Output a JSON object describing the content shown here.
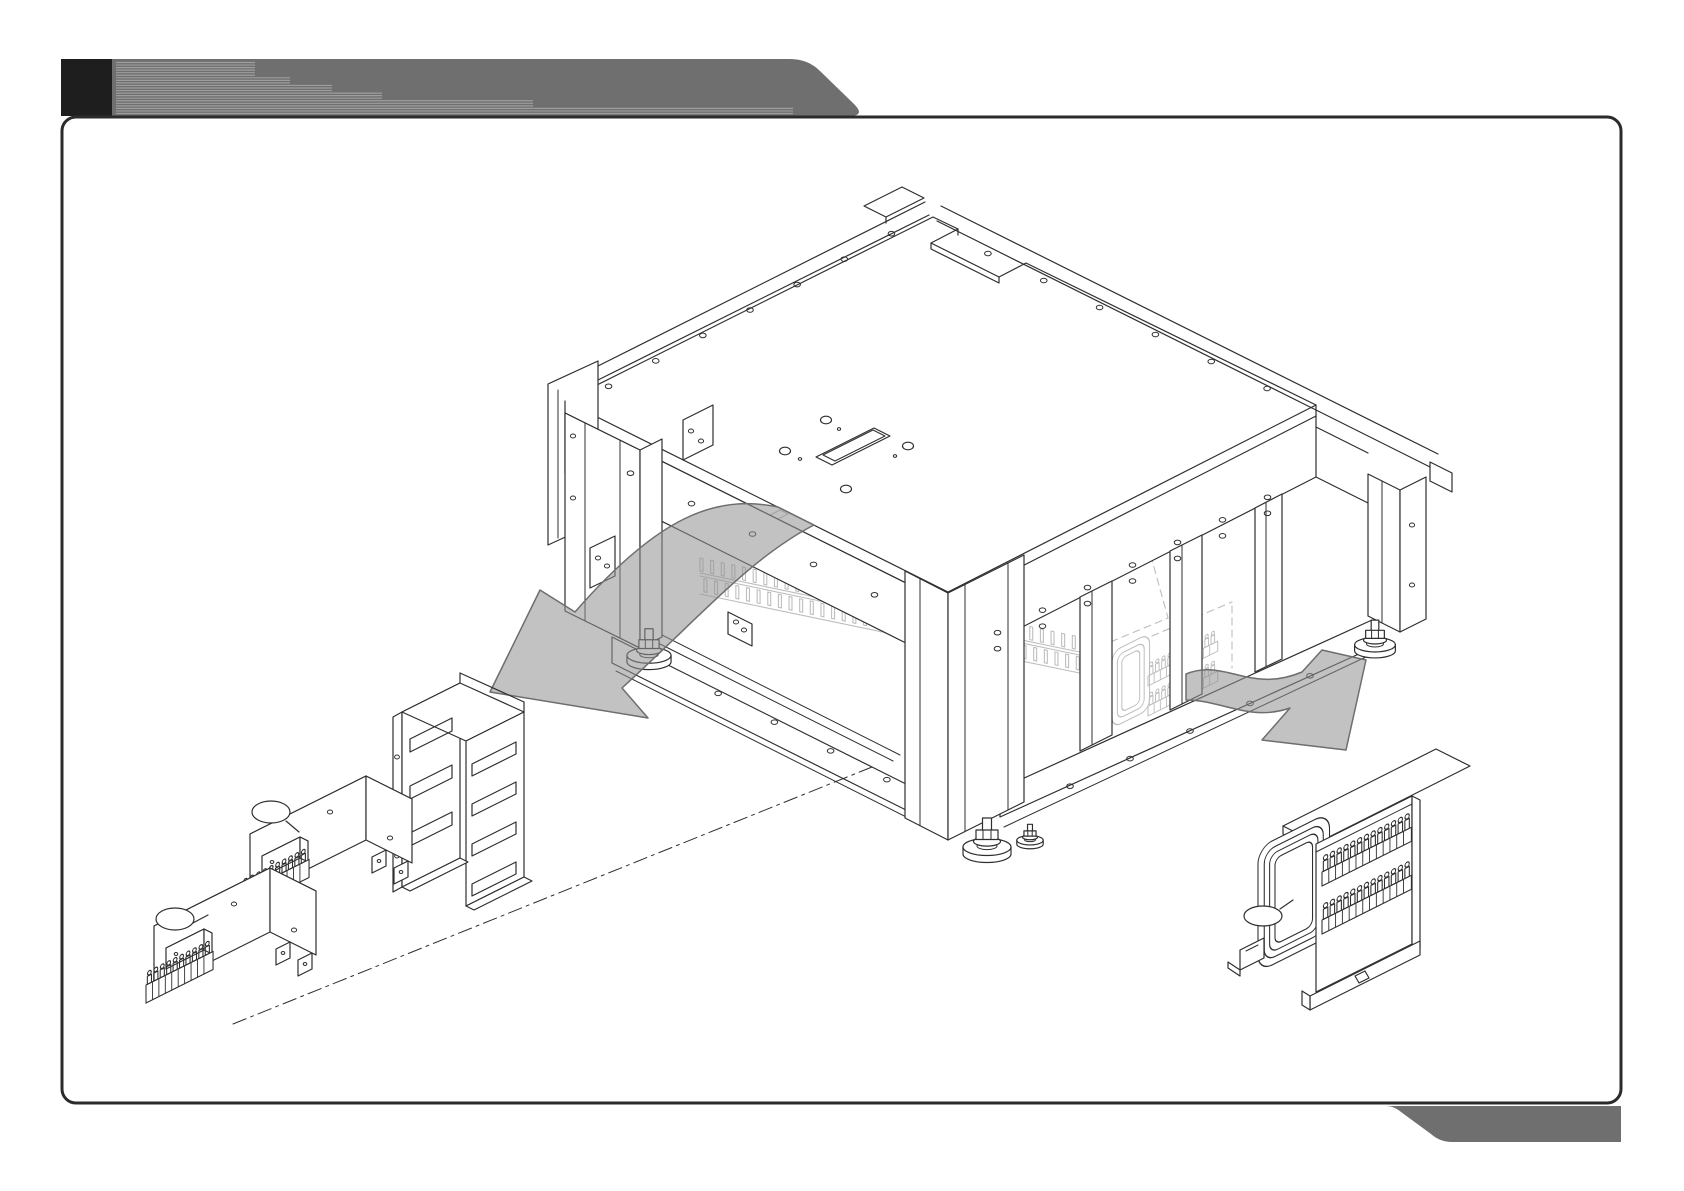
{
  "page": {
    "kind": "service-manual-diagram-page",
    "title_text": "",
    "background": "#ffffff"
  },
  "colors": {
    "page_bg": "#ffffff",
    "line": "#2f2f2f",
    "ghost": "#bdbdbd",
    "border": "#2b2b2b",
    "banner": "#6f6f6f",
    "banner_stripe": "#9e9e9e",
    "banner_block": "#1e1e1e",
    "footer_bar": "#6f6f6f",
    "arrow_fill": "#8f8f8f",
    "arrow_stroke": "#6e6e6e"
  },
  "figure": {
    "type": "exploded-isometric-assembly-diagram",
    "machine": "machine-base-frame",
    "extracted_parts": [
      "power-supply-unit-lower",
      "power-supply-unit-upper",
      "mounting-bracket",
      "transformer"
    ],
    "callouts": [
      {
        "id": 1,
        "label": ""
      },
      {
        "id": 2,
        "label": ""
      },
      {
        "id": 3,
        "label": ""
      }
    ]
  }
}
